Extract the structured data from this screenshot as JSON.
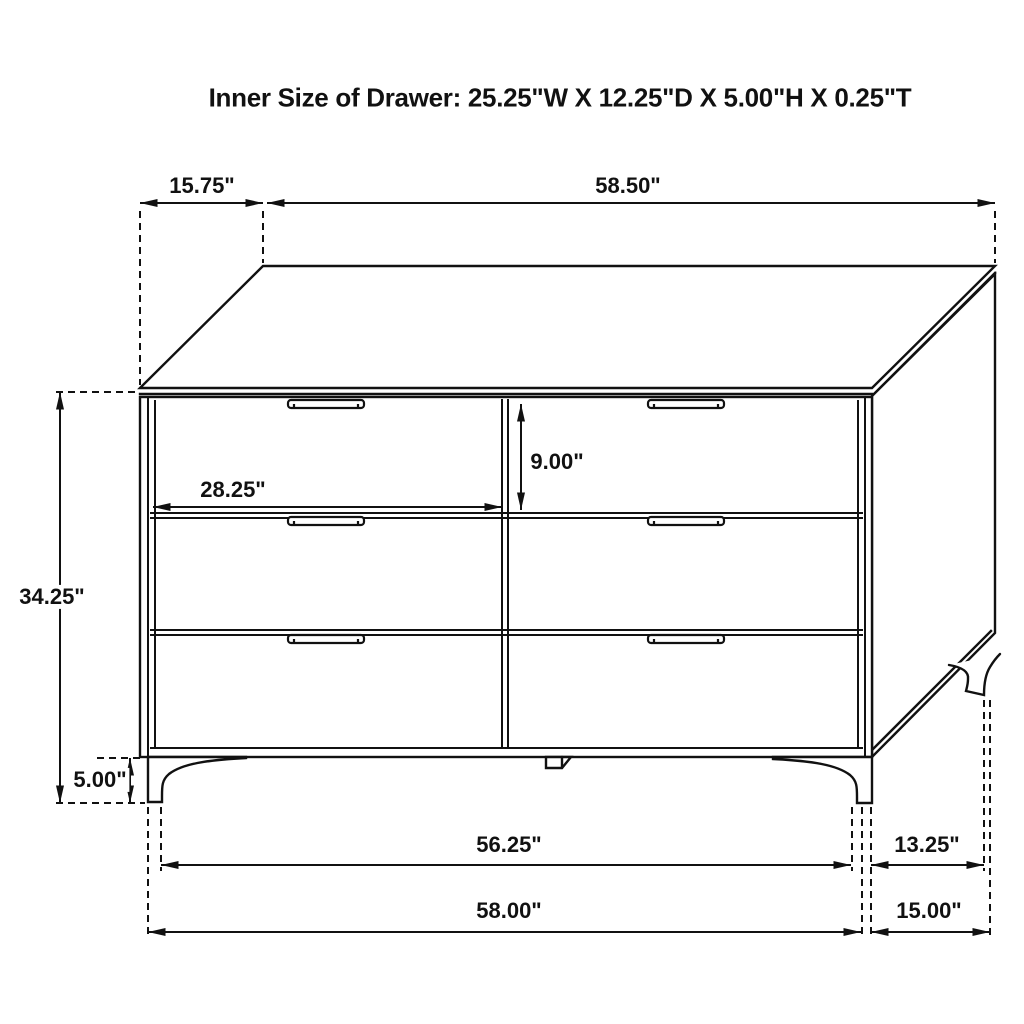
{
  "title": "Inner Size of Drawer: 25.25\"W X 12.25\"D X 5.00\"H X 0.25\"T",
  "dimensions": {
    "top_depth": "15.75\"",
    "top_width": "58.50\"",
    "overall_height": "34.25\"",
    "leg_height": "5.00\"",
    "drawer_opening_width": "28.25\"",
    "drawer_opening_height": "9.00\"",
    "front_leg_span": "56.25\"",
    "side_leg_span": "13.25\"",
    "overall_width": "58.00\"",
    "overall_depth": "15.00\""
  },
  "colors": {
    "line": "#111111",
    "background": "#ffffff"
  }
}
